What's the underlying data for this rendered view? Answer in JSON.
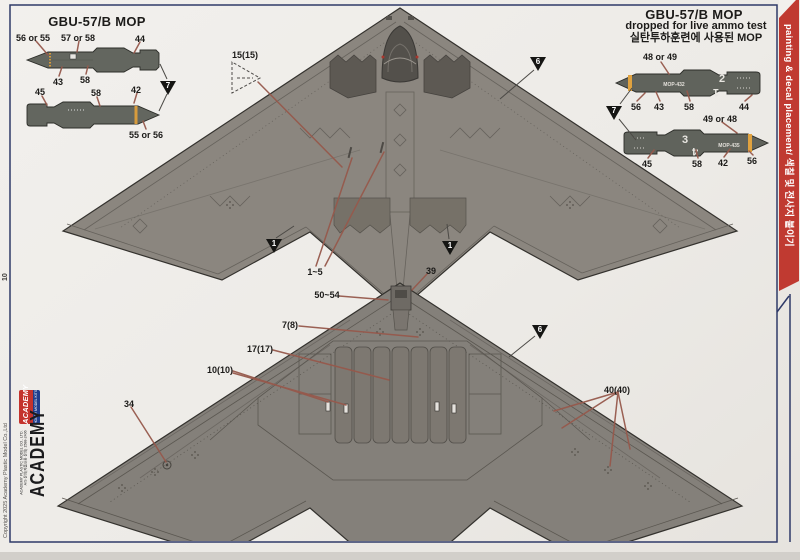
{
  "page": {
    "number": "10",
    "copyright": "Copyright 2025 Academy Plastic Model Co.,Ltd"
  },
  "side_tab": {
    "text": "painting & decal placement/ 색칠 및 전사지 붙이기",
    "color": "#c03a31"
  },
  "brand": {
    "logo_text": "ACADEMY",
    "logo_sub": "HOBBY MODEL KITS",
    "wordmark": "ACADEMY",
    "company_line1": "ACADEMY PLASTIC MODEL CO., LTD.",
    "company_line2": "A/S 문의(제품내용 문의) 1588-2406"
  },
  "left_diagram": {
    "title": "GBU-57/B MOP",
    "marker": "7",
    "callouts": {
      "top_left": "56 or 55",
      "top_mid": "57 or 58",
      "top_right": "44",
      "bottom_left": "43",
      "bottom_mid": "58",
      "b2_left": "45",
      "b2_mid": "58",
      "b2_right": "42",
      "b2_below": "55 or 56"
    }
  },
  "right_diagram": {
    "title": "GBU-57/B MOP",
    "subtitle": "dropped for live ammo test",
    "subtitle_kr": "실탄투하훈련에 사용된 MOP",
    "marker": "7",
    "top_bomb": {
      "above": "48 or 49",
      "stencil": "MOP-432",
      "digit_upper": "2",
      "digit_lower": "1",
      "below_1": "56",
      "below_2": "43",
      "below_3": "58",
      "below_4": "44"
    },
    "bottom_bomb": {
      "above": "49 or 48",
      "stencil": "MOP-435",
      "digit_upper": "3",
      "digit_lower": "4",
      "below_1": "45",
      "below_2": "58",
      "below_3": "42",
      "below_4": "56"
    }
  },
  "top_view": {
    "decal_box": "15(15)",
    "range": "1~5",
    "marker_wing": "6",
    "marker_notch": "1"
  },
  "bottom_view": {
    "nose": "39",
    "nose2": "50~54",
    "c7": "7(8)",
    "c17": "17(17)",
    "c10": "10(10)",
    "c34": "34",
    "c40": "40(40)",
    "marker_wing": "6"
  }
}
